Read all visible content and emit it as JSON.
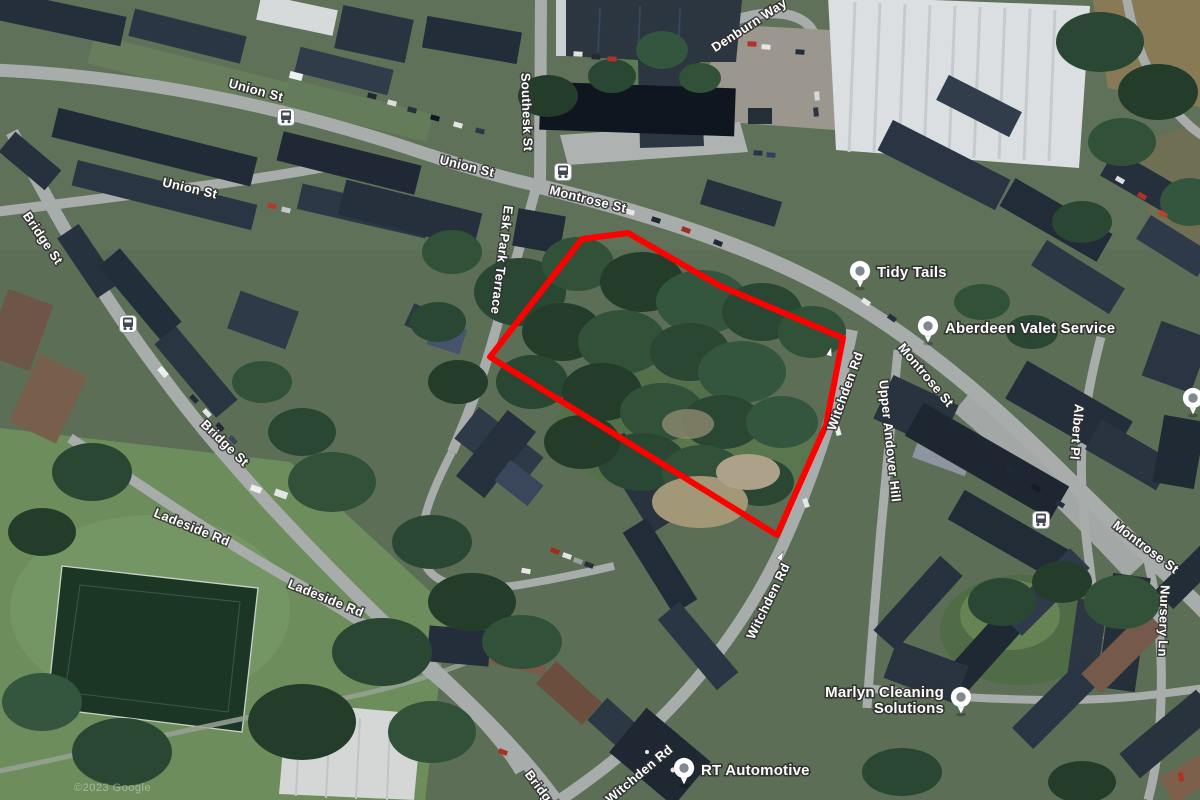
{
  "map": {
    "view": "satellite",
    "attribution": "©2023 Google",
    "site_outline": {
      "color": "#ff0000",
      "stroke_width": 6,
      "points": "490,357 582,239 628,233 720,286 843,338 826,425 777,535"
    },
    "street_labels": [
      {
        "text": "Union St",
        "x": 256,
        "y": 90,
        "rotate": 15
      },
      {
        "text": "Union St",
        "x": 467,
        "y": 166,
        "rotate": 14
      },
      {
        "text": "Union St",
        "x": 190,
        "y": 188,
        "rotate": 13
      },
      {
        "text": "Southesk St",
        "x": 527,
        "y": 112,
        "rotate": 88,
        "size": 12
      },
      {
        "text": "Montrose St",
        "x": 588,
        "y": 199,
        "rotate": 14
      },
      {
        "text": "Esk Park Terrace",
        "x": 502,
        "y": 260,
        "rotate": 97,
        "size": 12
      },
      {
        "text": "Bridge St",
        "x": 43,
        "y": 238,
        "rotate": 56
      },
      {
        "text": "Bridge St",
        "x": 225,
        "y": 443,
        "rotate": 44
      },
      {
        "text": "Ladeside Rd",
        "x": 192,
        "y": 527,
        "rotate": 22
      },
      {
        "text": "Ladeside Rd",
        "x": 326,
        "y": 598,
        "rotate": 22
      },
      {
        "text": "Denburn Way",
        "x": 749,
        "y": 25,
        "rotate": -33
      },
      {
        "text": "Montrose St",
        "x": 926,
        "y": 375,
        "rotate": 50
      },
      {
        "text": "Witchden Rd",
        "x": 845,
        "y": 391,
        "rotate": -70
      },
      {
        "text": "Upper Andover Hill",
        "x": 890,
        "y": 441,
        "rotate": 84,
        "size": 12
      },
      {
        "text": "Witchden Rd",
        "x": 768,
        "y": 601,
        "rotate": -64
      },
      {
        "text": "Witchden Rd",
        "x": 639,
        "y": 774,
        "rotate": -40
      },
      {
        "text": "Bridge St",
        "x": 546,
        "y": 796,
        "rotate": 53
      },
      {
        "text": "Albert Pl",
        "x": 1077,
        "y": 432,
        "rotate": 95
      },
      {
        "text": "Montrose St",
        "x": 1146,
        "y": 547,
        "rotate": 37
      },
      {
        "text": "Nursery Ln",
        "x": 1164,
        "y": 621,
        "rotate": 92
      }
    ],
    "poi": [
      {
        "name": "Tidy Tails",
        "pin": {
          "x": 860,
          "y": 271
        },
        "label": {
          "x": 877,
          "y": 272,
          "anchor": "start",
          "lines": [
            "Tidy Tails"
          ]
        }
      },
      {
        "name": "Aberdeen Valet Service",
        "pin": {
          "x": 928,
          "y": 326
        },
        "label": {
          "x": 945,
          "y": 328,
          "anchor": "start",
          "lines": [
            "Aberdeen Valet Service"
          ]
        }
      },
      {
        "name": "Marlyn Cleaning Solutions",
        "pin": {
          "x": 961,
          "y": 697
        },
        "label": {
          "x": 944,
          "y": 692,
          "anchor": "end",
          "lines": [
            "Marlyn Cleaning",
            "Solutions"
          ]
        }
      },
      {
        "name": "RT Automotive",
        "pin": {
          "x": 684,
          "y": 768
        },
        "label": {
          "x": 701,
          "y": 770,
          "anchor": "start",
          "lines": [
            "RT Automotive"
          ]
        }
      },
      {
        "name": "unlabeled",
        "pin": {
          "x": 1193,
          "y": 398
        },
        "label": null
      }
    ],
    "bus_stops": [
      {
        "x": 286,
        "y": 117
      },
      {
        "x": 128,
        "y": 324
      },
      {
        "x": 563,
        "y": 172
      },
      {
        "x": 1041,
        "y": 520
      }
    ],
    "one_way_arrows": [
      {
        "x": 781,
        "y": 556,
        "rotate": -62
      },
      {
        "x": 830,
        "y": 352,
        "rotate": -75
      }
    ]
  }
}
